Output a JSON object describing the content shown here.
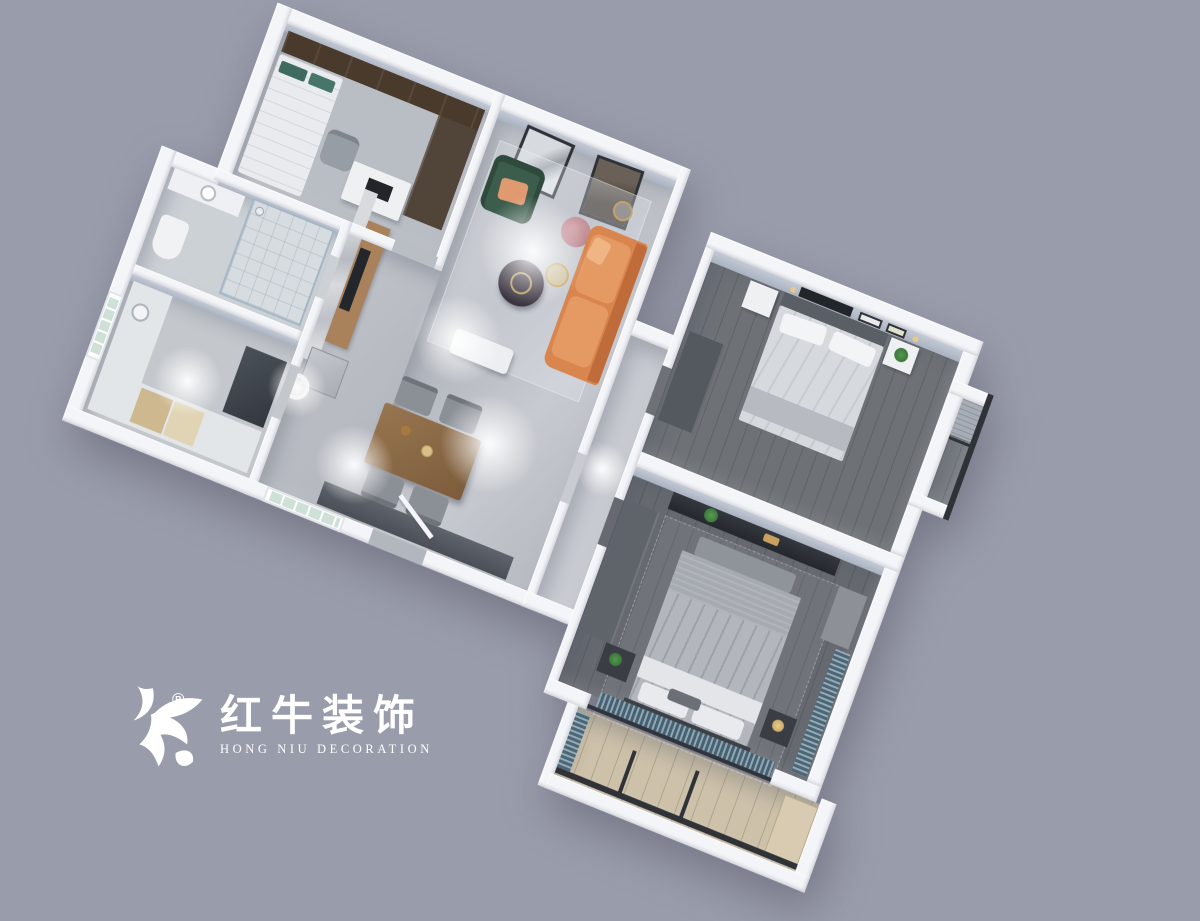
{
  "background_color": "#999cab",
  "logo": {
    "cn": "红牛装饰",
    "en": "HONG NIU DECORATION",
    "registered_mark": "®",
    "color": "#ffffff"
  },
  "palette": {
    "wall": "#f4f5f8",
    "floor_living_marble": "#bcc0c7",
    "floor_bedroom_wood": "#6e7277",
    "floor_master_wood": "#666a70",
    "floor_balcony_wood": "#cdc1a9",
    "sofa_orange": "#d9854e",
    "armchair_green": "#3c5d4c",
    "pouf_pink": "#c48f96",
    "table_wood": "#8a6746",
    "curtain_blue": "#5c7d90",
    "wardrobe_dark_wood": "#4a3a2c",
    "tv_black": "#23262b"
  },
  "floor_plan": {
    "view": "3d-birdseye-render",
    "rooms": [
      {
        "id": "study",
        "name": "study-bedroom"
      },
      {
        "id": "bath",
        "name": "bathroom"
      },
      {
        "id": "kitchen",
        "name": "kitchen"
      },
      {
        "id": "living",
        "name": "living-dining-room"
      },
      {
        "id": "corridor",
        "name": "hallway"
      },
      {
        "id": "bedroom2",
        "name": "second-bedroom"
      },
      {
        "id": "master",
        "name": "master-bedroom"
      },
      {
        "id": "balcony",
        "name": "balcony"
      }
    ],
    "furniture": {
      "study": [
        "wardrobe",
        "single-bed",
        "desk",
        "chair"
      ],
      "bath": [
        "vanity",
        "toilet",
        "shower"
      ],
      "kitchen": [
        "counter",
        "cooktop",
        "cabinets",
        "window"
      ],
      "living": [
        "tv-wall",
        "tv-console",
        "green-armchair",
        "pink-pouf",
        "coffee-tables",
        "orange-sofa",
        "bench",
        "dining-table",
        "dining-chairs",
        "sideboard",
        "fridge",
        "art-frames",
        "pendant-lamp"
      ],
      "bedroom2": [
        "double-bed",
        "nightstands",
        "wardrobe",
        "wall-tv",
        "picture-frames",
        "bay-window"
      ],
      "master": [
        "double-bed",
        "nightstands",
        "wardrobe",
        "tv-console",
        "bench",
        "dresser",
        "curtains"
      ],
      "balcony": [
        "wood-deck",
        "cabinet",
        "glazing"
      ]
    }
  }
}
